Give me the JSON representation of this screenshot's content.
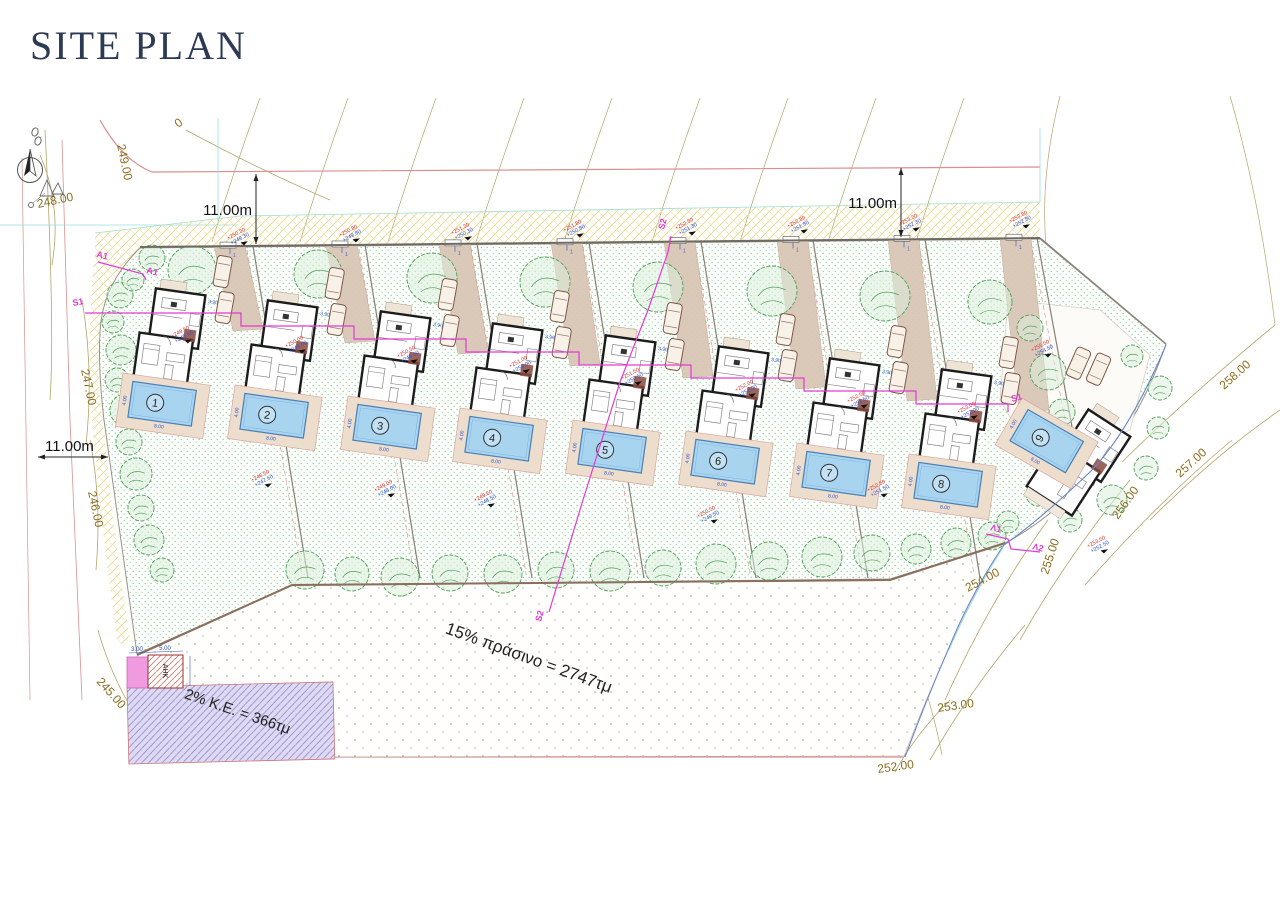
{
  "title": "SITE PLAN",
  "dimensions": {
    "top_left": "11.00m",
    "top_right": "11.00m",
    "left_side": "11.00m"
  },
  "contours": [
    "249.00",
    "248.00",
    "247.00",
    "246.00",
    "245.00",
    "0",
    "258.00",
    "257.00",
    "256.00",
    "255.00",
    "254.00",
    "253.00",
    "252.00"
  ],
  "areas": {
    "green_note": "15% πράσινο = 2747τμ",
    "building_coeff_note": "2% K.E. = 366τμ",
    "substation_label": "ΑΗΚ",
    "substation_width": "3.00",
    "substation_length": "5.00"
  },
  "sections": {
    "a1": "A1",
    "s1": "S1",
    "s2": "S2",
    "l1": "Λ1",
    "l2": "Λ2"
  },
  "parking_dim": "3.90",
  "plots": [
    {
      "number": "1",
      "pool_length": "8.00",
      "pool_width": "4.00"
    },
    {
      "number": "2",
      "pool_length": "8.00",
      "pool_width": "4.00"
    },
    {
      "number": "3",
      "pool_length": "8.00",
      "pool_width": "4.00"
    },
    {
      "number": "4",
      "pool_length": "8.00",
      "pool_width": "4.00"
    },
    {
      "number": "5",
      "pool_length": "8.00",
      "pool_width": "4.00"
    },
    {
      "number": "6",
      "pool_length": "8.00",
      "pool_width": "4.00"
    },
    {
      "number": "7",
      "pool_length": "8.00",
      "pool_width": "4.00"
    },
    {
      "number": "8",
      "pool_length": "8.00",
      "pool_width": "4.00"
    },
    {
      "number": "9",
      "pool_length": "8.00",
      "pool_width": "4.00"
    }
  ],
  "spot_elevations": [
    {
      "red": "+250.30",
      "blue": "+249.30"
    },
    {
      "red": "+250.80",
      "blue": "+249.80"
    },
    {
      "red": "+251.30",
      "blue": "+250.30"
    },
    {
      "red": "+251.80",
      "blue": "+250.80"
    },
    {
      "red": "+252.30",
      "blue": "+251.30"
    },
    {
      "red": "+252.80",
      "blue": "+251.80"
    },
    {
      "red": "+253.30",
      "blue": "+252.30"
    },
    {
      "red": "+253.80",
      "blue": "+252.80"
    },
    {
      "red": "+249.50",
      "blue": "+248.50"
    },
    {
      "red": "+250.00",
      "blue": "+249.00"
    },
    {
      "red": "+250.50",
      "blue": "+249.50"
    },
    {
      "red": "+251.00",
      "blue": "+250.00"
    },
    {
      "red": "+251.50",
      "blue": "+250.50"
    },
    {
      "red": "+252.00",
      "blue": "+251.00"
    },
    {
      "red": "+252.50",
      "blue": "+251.50"
    },
    {
      "red": "+253.00",
      "blue": "+252.00"
    },
    {
      "red": "+248.50",
      "blue": "+247.50"
    },
    {
      "red": "+249.50",
      "blue": "+248.50"
    },
    {
      "red": "+250.50",
      "blue": "+249.50"
    },
    {
      "red": "+252.50",
      "blue": "+251.50"
    },
    {
      "red": "+255.50",
      "blue": "+254.50"
    },
    {
      "red": "+253.50",
      "blue": "+252.50"
    },
    {
      "red": "+249.00",
      "blue": "+248.00"
    }
  ],
  "colors": {
    "title": "#2d3a55",
    "section_line": "#e23ad6",
    "pool_water": "#a8d4f0",
    "contour_label": "#8a6d1f",
    "spot_red": "#d93030",
    "spot_blue": "#3050d0"
  }
}
